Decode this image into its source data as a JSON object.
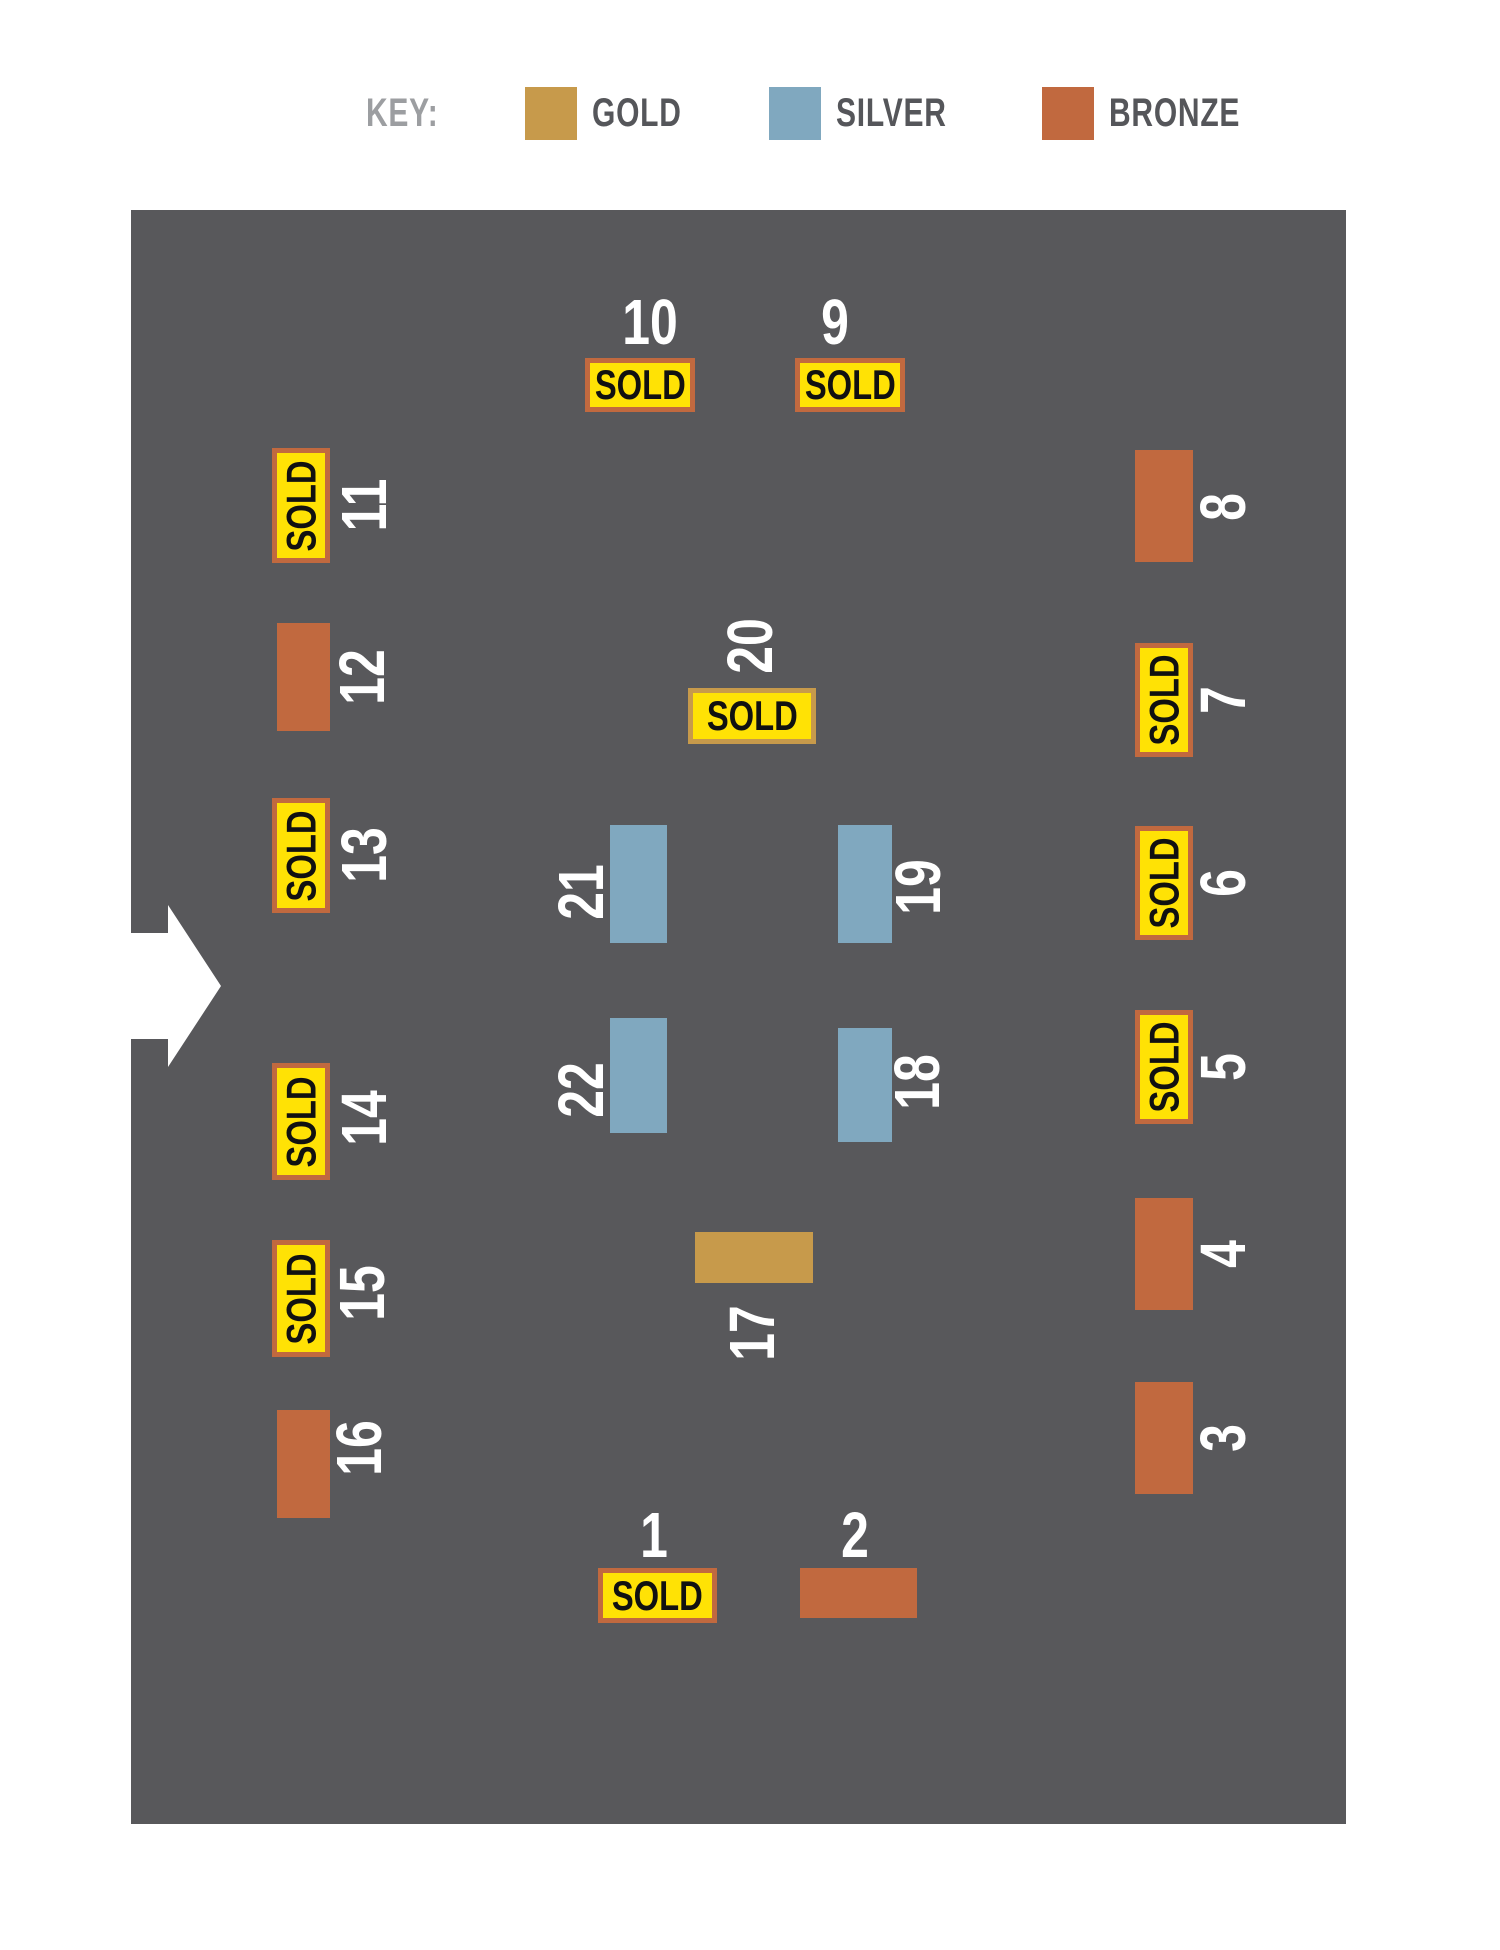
{
  "key": {
    "label": "KEY:",
    "items": [
      {
        "label": "GOLD",
        "tier": "gold",
        "color": "#C79A4B"
      },
      {
        "label": "SILVER",
        "tier": "silver",
        "color": "#80A8BF"
      },
      {
        "label": "BRONZE",
        "tier": "bronze",
        "color": "#C1693F"
      }
    ]
  },
  "sold_label": "SOLD",
  "colors": {
    "map_background": "#58585B",
    "badge_yellow": "#FFE205",
    "number_white": "#FFFFFF",
    "sold_text": "#111111",
    "key_title_gray": "#9C9EA1",
    "key_label_dark": "#55565A",
    "arrow_white": "#FFFFFF"
  },
  "tier_colors": {
    "gold": "#C79A4B",
    "silver": "#80A8BF",
    "bronze": "#C1693F"
  },
  "booths": [
    {
      "number": "1",
      "tier": "bronze",
      "sold": true,
      "orient": "h",
      "x": 467,
      "y": 1358,
      "w": 119,
      "h": 55,
      "nx": 523,
      "ny": 1325,
      "nrot": false
    },
    {
      "number": "2",
      "tier": "bronze",
      "sold": false,
      "orient": "h",
      "x": 669,
      "y": 1358,
      "w": 117,
      "h": 50,
      "nx": 724,
      "ny": 1325,
      "nrot": false
    },
    {
      "number": "3",
      "tier": "bronze",
      "sold": false,
      "orient": "v",
      "x": 1004,
      "y": 1172,
      "w": 58,
      "h": 112,
      "nx": 1092,
      "ny": 1228,
      "nrot": true
    },
    {
      "number": "4",
      "tier": "bronze",
      "sold": false,
      "orient": "v",
      "x": 1004,
      "y": 988,
      "w": 58,
      "h": 112,
      "nx": 1092,
      "ny": 1044,
      "nrot": true
    },
    {
      "number": "5",
      "tier": "bronze",
      "sold": true,
      "orient": "v",
      "x": 1004,
      "y": 800,
      "w": 58,
      "h": 114,
      "nx": 1092,
      "ny": 857,
      "nrot": true
    },
    {
      "number": "6",
      "tier": "bronze",
      "sold": true,
      "orient": "v",
      "x": 1004,
      "y": 616,
      "w": 58,
      "h": 114,
      "nx": 1092,
      "ny": 673,
      "nrot": true
    },
    {
      "number": "7",
      "tier": "bronze",
      "sold": true,
      "orient": "v",
      "x": 1004,
      "y": 433,
      "w": 58,
      "h": 114,
      "nx": 1092,
      "ny": 490,
      "nrot": true
    },
    {
      "number": "8",
      "tier": "bronze",
      "sold": false,
      "orient": "v",
      "x": 1004,
      "y": 240,
      "w": 58,
      "h": 112,
      "nx": 1092,
      "ny": 297,
      "nrot": true
    },
    {
      "number": "9",
      "tier": "bronze",
      "sold": true,
      "orient": "h",
      "x": 664,
      "y": 148,
      "w": 110,
      "h": 54,
      "nx": 704,
      "ny": 112,
      "nrot": false
    },
    {
      "number": "10",
      "tier": "bronze",
      "sold": true,
      "orient": "h",
      "x": 454,
      "y": 148,
      "w": 110,
      "h": 54,
      "nx": 519,
      "ny": 112,
      "nrot": false
    },
    {
      "number": "11",
      "tier": "bronze",
      "sold": true,
      "orient": "v",
      "x": 141,
      "y": 238,
      "w": 58,
      "h": 115,
      "nx": 233,
      "ny": 295,
      "nrot": true
    },
    {
      "number": "12",
      "tier": "bronze",
      "sold": false,
      "orient": "v",
      "x": 146,
      "y": 413,
      "w": 53,
      "h": 108,
      "nx": 231,
      "ny": 467,
      "nrot": true
    },
    {
      "number": "13",
      "tier": "bronze",
      "sold": true,
      "orient": "v",
      "x": 141,
      "y": 588,
      "w": 58,
      "h": 115,
      "nx": 233,
      "ny": 645,
      "nrot": true
    },
    {
      "number": "14",
      "tier": "bronze",
      "sold": true,
      "orient": "v",
      "x": 141,
      "y": 853,
      "w": 58,
      "h": 117,
      "nx": 233,
      "ny": 908,
      "nrot": true
    },
    {
      "number": "15",
      "tier": "bronze",
      "sold": true,
      "orient": "v",
      "x": 141,
      "y": 1030,
      "w": 58,
      "h": 117,
      "nx": 231,
      "ny": 1083,
      "nrot": true
    },
    {
      "number": "16",
      "tier": "bronze",
      "sold": false,
      "orient": "v",
      "x": 146,
      "y": 1200,
      "w": 53,
      "h": 108,
      "nx": 228,
      "ny": 1238,
      "nrot": true
    },
    {
      "number": "17",
      "tier": "gold",
      "sold": false,
      "orient": "h",
      "x": 564,
      "y": 1022,
      "w": 118,
      "h": 51,
      "nx": 621,
      "ny": 1123,
      "nrot": true
    },
    {
      "number": "18",
      "tier": "silver",
      "sold": false,
      "orient": "v",
      "x": 707,
      "y": 818,
      "w": 54,
      "h": 114,
      "nx": 786,
      "ny": 872,
      "nrot": true
    },
    {
      "number": "19",
      "tier": "silver",
      "sold": false,
      "orient": "v",
      "x": 707,
      "y": 615,
      "w": 54,
      "h": 118,
      "nx": 787,
      "ny": 677,
      "nrot": true
    },
    {
      "number": "20",
      "tier": "gold",
      "sold": true,
      "orient": "h",
      "x": 557,
      "y": 478,
      "w": 128,
      "h": 56,
      "nx": 619,
      "ny": 436,
      "nrot": true
    },
    {
      "number": "21",
      "tier": "silver",
      "sold": false,
      "orient": "v",
      "x": 479,
      "y": 615,
      "w": 57,
      "h": 118,
      "nx": 450,
      "ny": 682,
      "nrot": true
    },
    {
      "number": "22",
      "tier": "silver",
      "sold": false,
      "orient": "v",
      "x": 479,
      "y": 808,
      "w": 57,
      "h": 115,
      "nx": 450,
      "ny": 880,
      "nrot": true
    }
  ]
}
